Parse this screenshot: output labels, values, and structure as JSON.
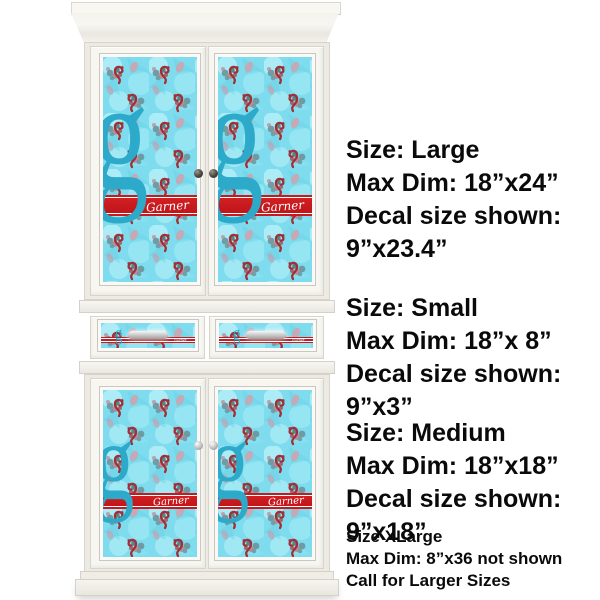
{
  "monogram": {
    "letter": "g",
    "name": "Garner"
  },
  "colors": {
    "decal_background": "#7edcee",
    "ribbon_red": "#c9191c",
    "monogram_teal": "#2da9c9",
    "motif_dark_red": "#a12f34",
    "motif_teal_gray": "#6b98a0",
    "cabinet_white": "#f6f5f0",
    "annotation_text": "#0a0a0a"
  },
  "annotations": [
    {
      "id": "large",
      "lines": [
        "Size: Large",
        "Max Dim: 18”x24”",
        "Decal size shown:",
        "9”x23.4”"
      ]
    },
    {
      "id": "small",
      "lines": [
        "Size: Small",
        "Max Dim: 18”x 8”",
        "Decal size shown:",
        "9”x3”"
      ]
    },
    {
      "id": "medium",
      "lines": [
        "Size: Medium",
        "Max Dim: 18”x18”",
        "Decal size shown:",
        "9”x18”"
      ]
    },
    {
      "id": "xlarge",
      "lines": [
        "Size XLarge",
        "Max Dim: 8”x36 not shown",
        "Call for Larger Sizes"
      ]
    }
  ]
}
